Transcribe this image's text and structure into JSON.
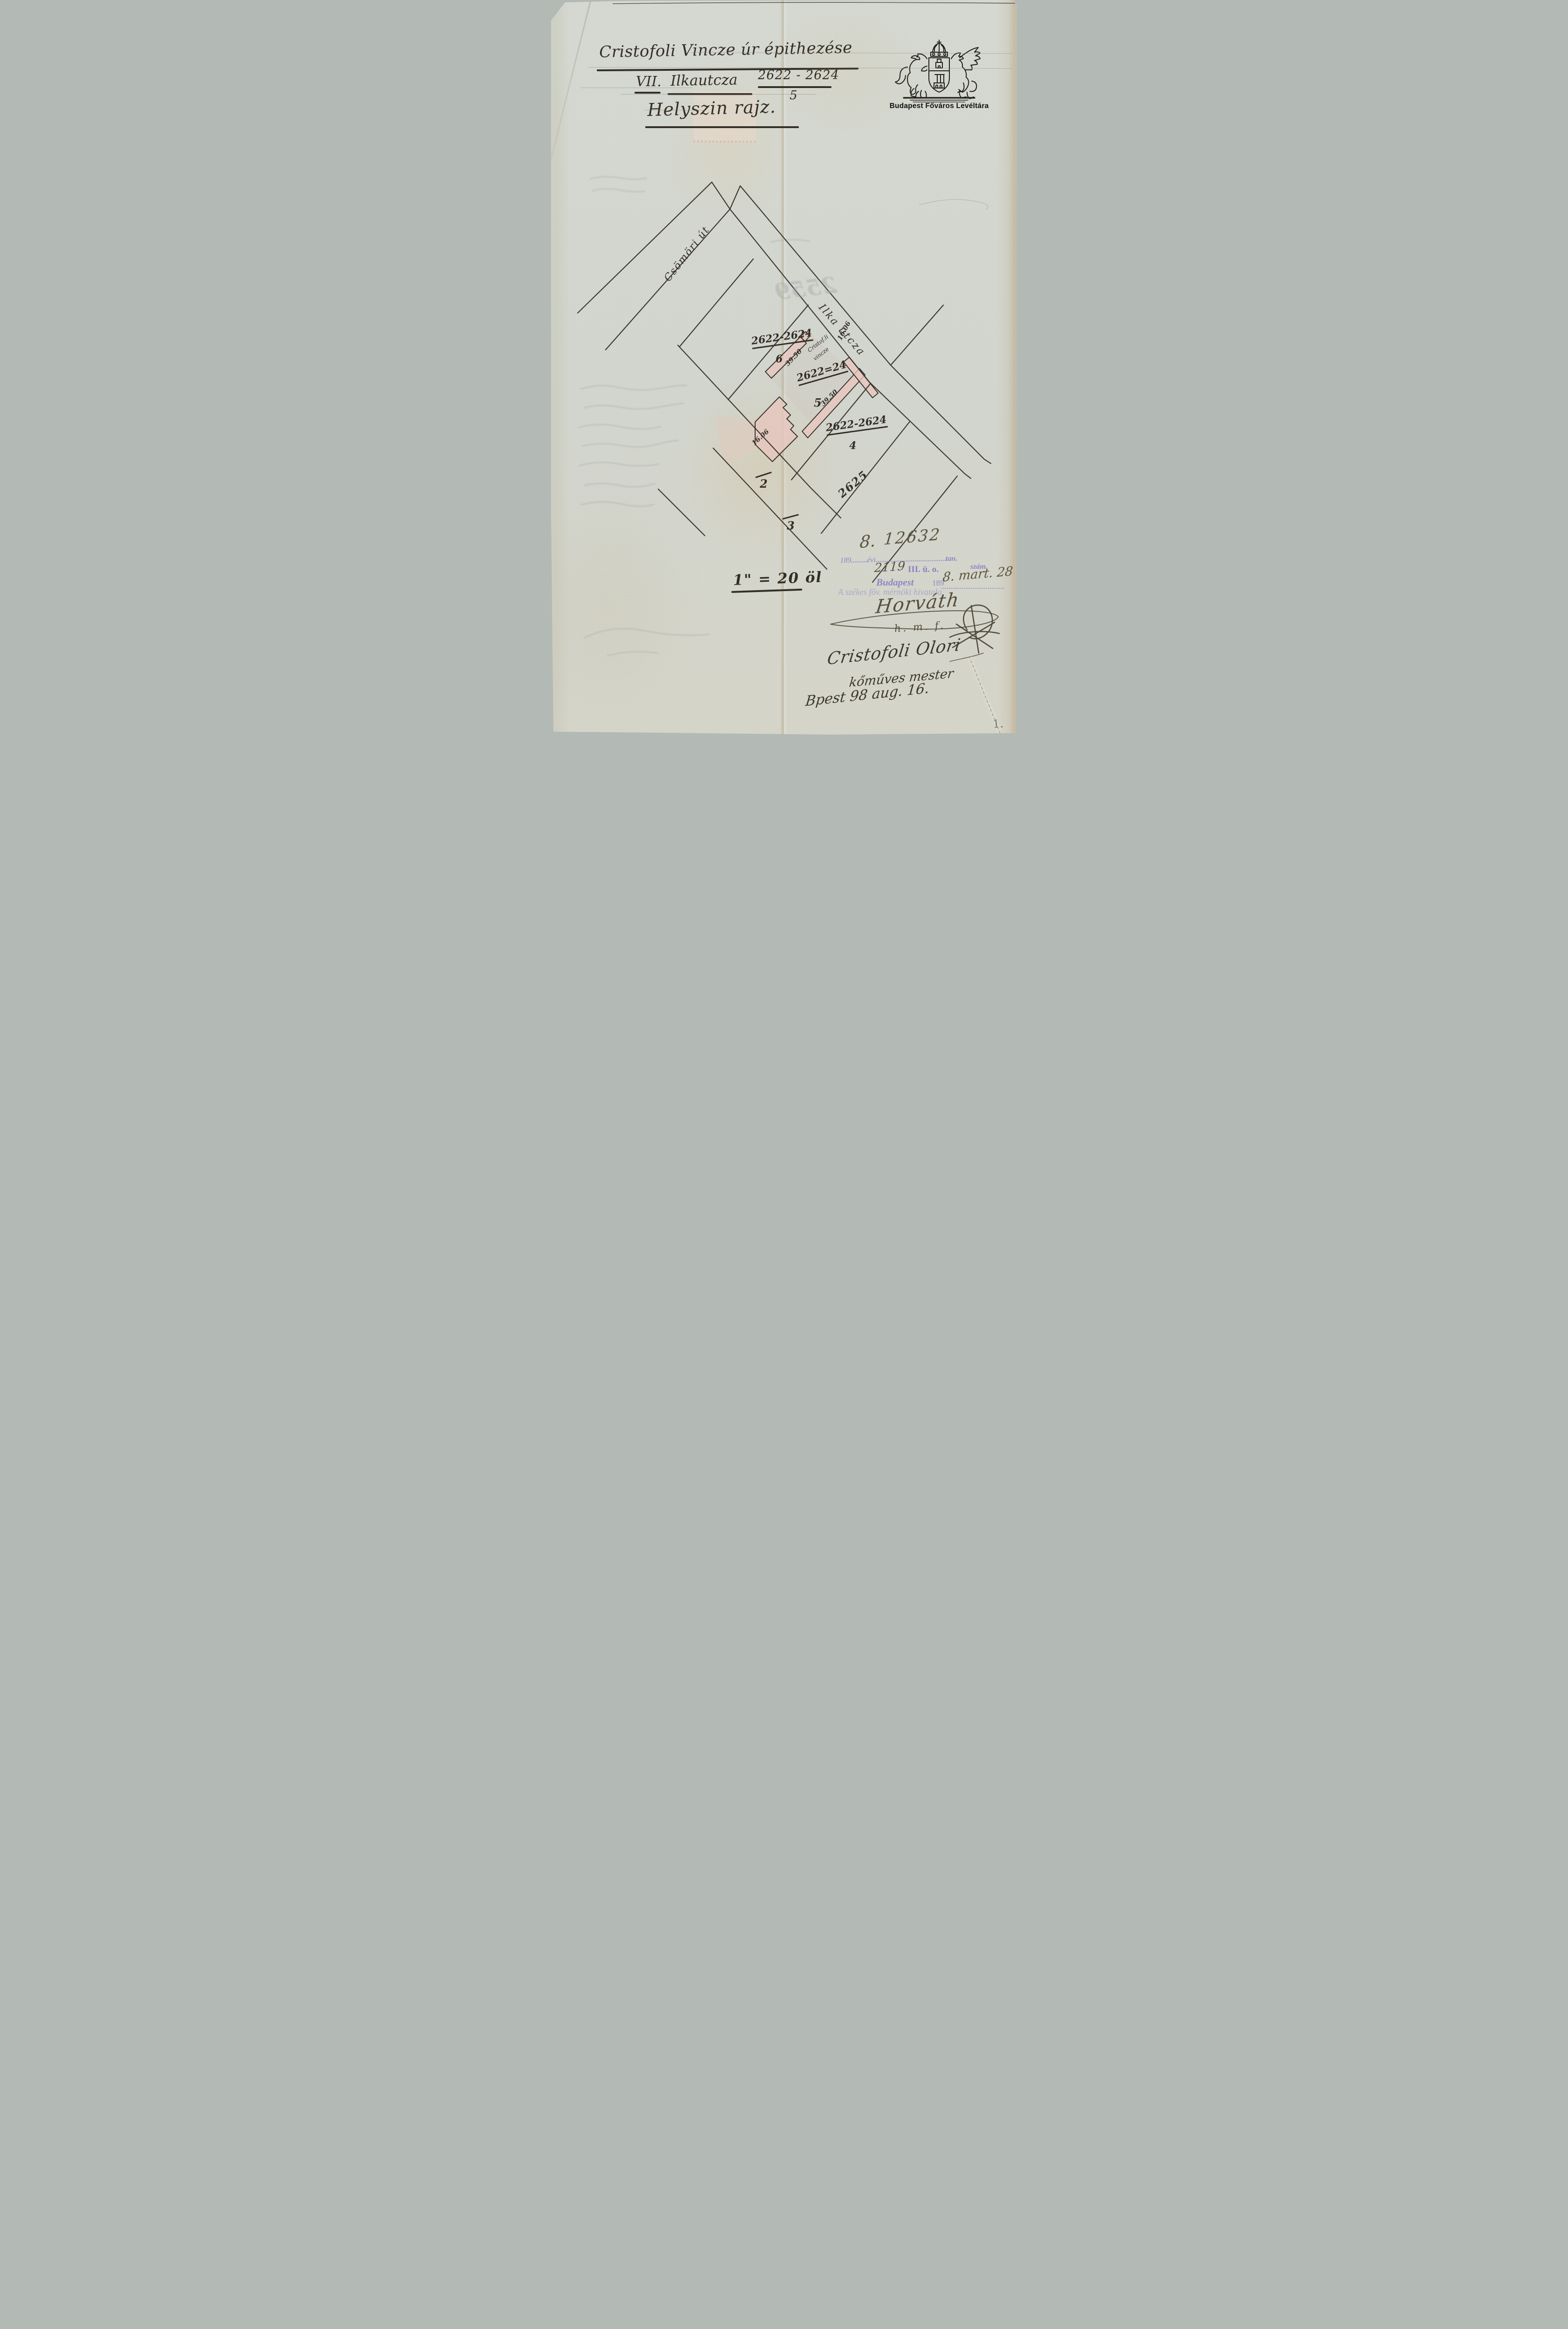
{
  "archive": {
    "caption": "Budapest Főváros Levéltára"
  },
  "title": {
    "line1": "Cristofoli Vincze úr épithezése",
    "district": "VII.",
    "street": "Ilkautcza",
    "lot": "2622 - 2624",
    "lot_sub": "5",
    "subtitle": "Helyszin rajz."
  },
  "map": {
    "street_csomori": "Csömöri út",
    "street_ilka": "Ilka utcza",
    "plot6": {
      "num": "2622-2624",
      "den": "6"
    },
    "plot5": {
      "num": "2622=24",
      "den": "5"
    },
    "plot4": {
      "num": "2622-2624",
      "den": "4"
    },
    "plot_2625": "2625",
    "plot_2": "2",
    "plot_3": "3",
    "owner_note_line1": "Cristof.li",
    "owner_note_line2": "vincze",
    "len_upper": "39.50",
    "len_lower": "39.50",
    "front_upper": "16.06",
    "front_lower": "16.06"
  },
  "scale_note": "1\" = 20 öl",
  "registry": {
    "entry_hand_prefix": "8.",
    "entry_hand_number": "12632",
    "stamp_year_prefix": "189",
    "stamp_evi": "évi",
    "stamp_tan": "tan.",
    "stamp_szam": "szám.",
    "ref_hand": "2119",
    "ref_stamp": "III. ü. o.",
    "stamp_city": "Budapest",
    "stamp_city_year": "189",
    "date_hand": "8. mart. 28",
    "office_stamp": "A székes főv. mérnöki hivatala."
  },
  "signatures": {
    "engineer": "Horváth",
    "engineer_note": "h. m. f.",
    "builder": "Cristofoli Olori",
    "builder_title": "kőműves mester",
    "place_date": "Bpest 98 aug. 16."
  },
  "bleedthrough": {
    "number": "2559"
  },
  "page_number": "1.",
  "colors": {
    "ink": "#332f28",
    "stamp_purple": "#8478c6",
    "building_pink": "#e8c7bf",
    "paper": "#d7dad2"
  }
}
